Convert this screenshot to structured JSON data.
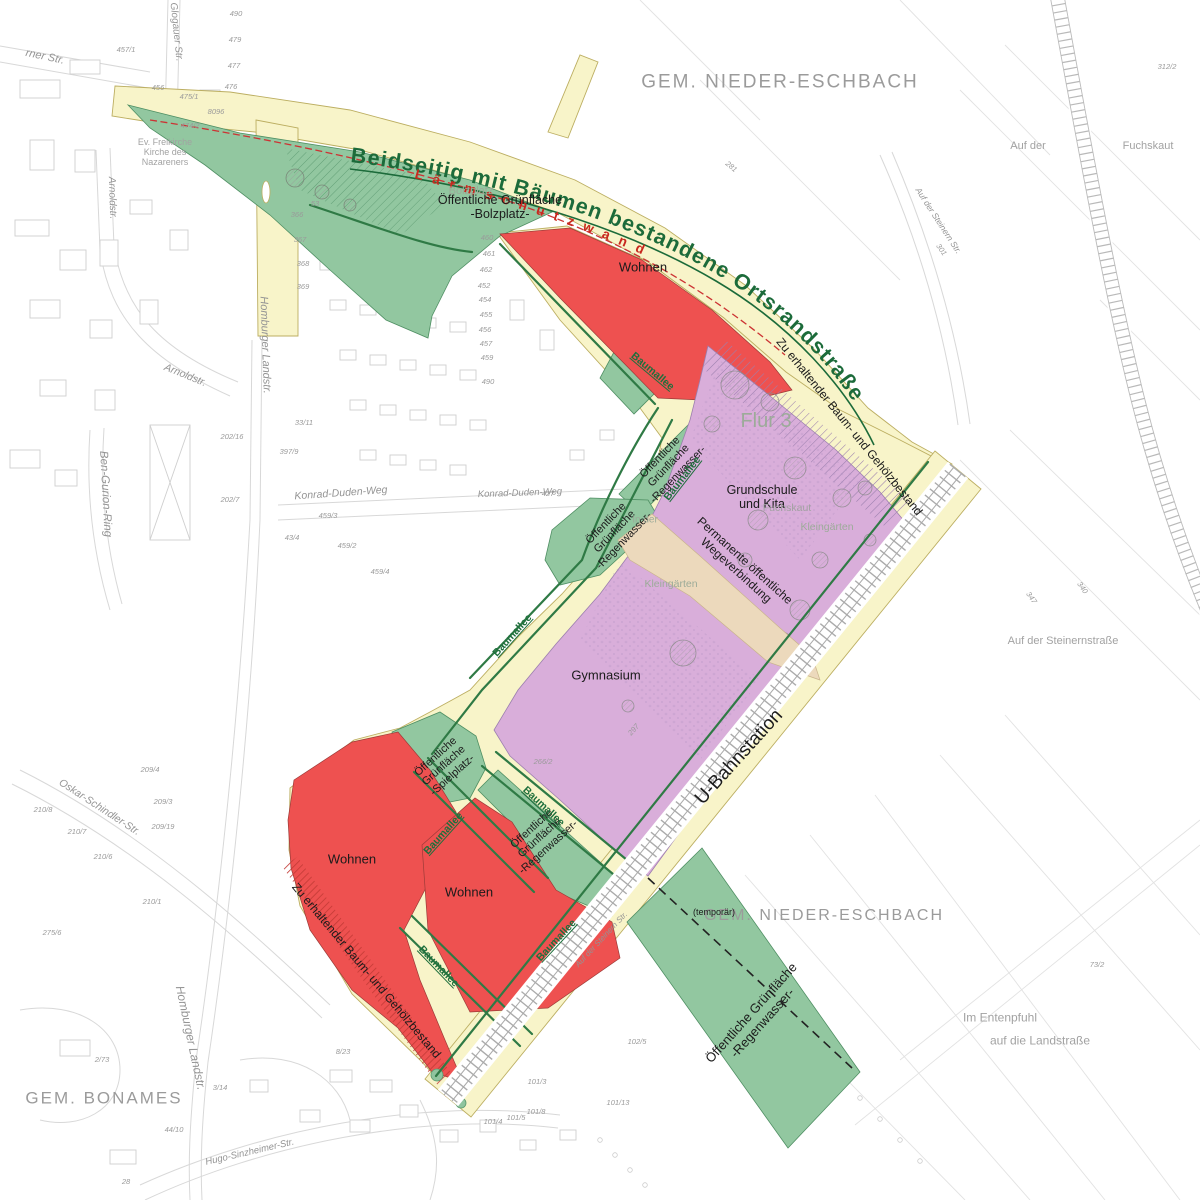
{
  "colors": {
    "road_yellow": "#f8f4c9",
    "road_edge": "#bcae61",
    "green_area": "#92c7a0",
    "green_edge": "#4f8f63",
    "red_area": "#ee5150",
    "red_hatch": "#c23a35",
    "purple_area": "#d9aeda",
    "purple_hatch": "#9b7fae",
    "tan_area": "#ecd9bc",
    "text_green": "#1c6b3a",
    "text_red": "#c8281e",
    "text_grey": "#9b9b9b",
    "rail_grey": "#909090"
  },
  "curved": {
    "ortsrandstrasse": "Beidseitig mit Bäumen bestandene Ortsrandstraße",
    "laermschutzwand": "Lärmschutzwand"
  },
  "map_labels": [
    {
      "n": "label-gem-nieder-eschbach-north",
      "t": "GEM. NIEDER-ESCHBACH",
      "x": 780,
      "y": 82,
      "s": 19,
      "c": "lab-region"
    },
    {
      "n": "label-gem-nieder-eschbach-south",
      "t": "GEM. NIEDER-ESCHBACH",
      "x": 824,
      "y": 916,
      "s": 16,
      "c": "lab-region"
    },
    {
      "n": "label-gem-bonames",
      "t": "GEM. BONAMES",
      "x": 104,
      "y": 1098,
      "s": 17,
      "c": "lab-region"
    },
    {
      "n": "label-wohnen-north",
      "t": "Wohnen",
      "x": 643,
      "y": 268,
      "s": 13,
      "c": "lab-zone"
    },
    {
      "n": "label-wohnen-west",
      "t": "Wohnen",
      "x": 352,
      "y": 860,
      "s": 13,
      "c": "lab-zone"
    },
    {
      "n": "label-wohnen-south",
      "t": "Wohnen",
      "x": 469,
      "y": 893,
      "s": 13,
      "c": "lab-zone"
    },
    {
      "n": "label-gymnasium",
      "t": "Gymnasium",
      "x": 606,
      "y": 676,
      "s": 13,
      "c": "lab-zone"
    },
    {
      "n": "label-grundschule-kita",
      "lines": [
        "Grundschule",
        "und Kita"
      ],
      "x": 762,
      "y": 497,
      "s": 12.5,
      "c": "lab-zone"
    },
    {
      "n": "label-gruenflaeche-bolzplatz",
      "lines": [
        "Öffentliche Grünfläche",
        "-Bolzplatz-"
      ],
      "x": 500,
      "y": 207,
      "s": 12.5,
      "c": "lab-zone"
    },
    {
      "n": "label-gruenflaeche-spielplatz",
      "lines": [
        "Öffentliche",
        "Grünfläche",
        "-Spielplatz-"
      ],
      "x": 444,
      "y": 766,
      "r": -42,
      "s": 11,
      "c": "lab-zone"
    },
    {
      "n": "label-gruenflaeche-regenwasser-west",
      "lines": [
        "Öffentliche",
        "Grünfläche",
        "-Regenwasser-"
      ],
      "x": 540,
      "y": 838,
      "r": -42,
      "s": 11,
      "c": "lab-zone"
    },
    {
      "n": "label-gruenflaeche-regenwasser-nord1",
      "lines": [
        "Öffentliche",
        "Grünfläche",
        "-Regenwasser-"
      ],
      "x": 669,
      "y": 466,
      "r": -46,
      "s": 11,
      "c": "lab-zone"
    },
    {
      "n": "label-gruenflaeche-regenwasser-nord2",
      "lines": [
        "Öffentliche",
        "Grünfläche",
        "-Regenwasser-"
      ],
      "x": 615,
      "y": 532,
      "r": -46,
      "s": 11,
      "c": "lab-zone"
    },
    {
      "n": "label-gruenflaeche-regenwasser-sued",
      "lines": [
        "Öffentliche Grünfläche",
        "-Regenwasser-"
      ],
      "x": 757,
      "y": 1018,
      "r": -48,
      "s": 13,
      "c": "lab-zone"
    },
    {
      "n": "label-temporaer",
      "t": "(temporär)",
      "x": 714,
      "y": 912,
      "s": 9,
      "c": "lab-zone"
    },
    {
      "n": "label-permanente-wegeverbindung",
      "lines": [
        "Permanente öffentliche",
        "Wegeverbindung"
      ],
      "x": 740,
      "y": 566,
      "r": 42,
      "s": 12,
      "c": "lab-zone"
    },
    {
      "n": "label-zu-erhaltender-bestand-north",
      "t": "Zu erhaltender Baum- und Gehölzbestand",
      "x": 849,
      "y": 427,
      "r": 51,
      "s": 12,
      "c": "lab-zone"
    },
    {
      "n": "label-zu-erhaltender-bestand-south",
      "t": "Zu erhaltender Baum- und Gehölzbestand",
      "x": 366,
      "y": 971,
      "r": 50,
      "s": 12,
      "c": "lab-zone"
    },
    {
      "n": "label-u-bahnstation",
      "t": "U-Bahnstation",
      "x": 739,
      "y": 757,
      "r": -48,
      "s": 19,
      "c": "lab-zone"
    },
    {
      "n": "label-flur-3",
      "t": "Flur 3",
      "x": 766,
      "y": 421,
      "s": 20,
      "c": "lab-greygreen"
    },
    {
      "n": "label-bolzplatz",
      "t": "Bolzplatz",
      "x": 471,
      "y": 191,
      "s": 11,
      "c": "lab-greygreen"
    },
    {
      "n": "label-kleingaerten-1",
      "t": "Kleingärten",
      "x": 827,
      "y": 528,
      "s": 10.5,
      "c": "lab-greygreen"
    },
    {
      "n": "label-kleingaerten-2",
      "t": "Kleingärten",
      "x": 671,
      "y": 585,
      "s": 10.5,
      "c": "lab-greygreen"
    },
    {
      "n": "label-fuchskaut-mitte",
      "t": "Fuchskaut",
      "x": 787,
      "y": 509,
      "s": 10.5,
      "c": "lab-grey"
    },
    {
      "n": "label-fuchskaut-nordost",
      "t": "Fuchskaut",
      "x": 1148,
      "y": 146,
      "s": 11,
      "c": "lab-grey"
    },
    {
      "n": "label-auf-der-nordost",
      "t": "Auf der",
      "x": 1028,
      "y": 146,
      "s": 11,
      "c": "lab-grey"
    },
    {
      "n": "label-auf-der-steinernstrasse",
      "t": "Auf der Steinernstraße",
      "x": 1063,
      "y": 641,
      "s": 11,
      "c": "lab-grey"
    },
    {
      "n": "label-im-entenpfuhl",
      "t": "Im Entenpfuhl",
      "x": 1000,
      "y": 1018,
      "s": 12,
      "c": "lab-grey"
    },
    {
      "n": "label-auf-die-landstrasse",
      "t": "auf die Landstraße",
      "x": 1040,
      "y": 1041,
      "s": 12,
      "c": "lab-grey"
    },
    {
      "n": "label-in-der",
      "t": "In der",
      "x": 645,
      "y": 520,
      "s": 10,
      "c": "lab-greygreen"
    },
    {
      "n": "label-ev-freikirche",
      "lines": [
        "Ev. Freikirche",
        "Kirche des",
        "Nazareners"
      ],
      "x": 165,
      "y": 152,
      "s": 9,
      "c": "lab-grey"
    },
    {
      "n": "label-baumallee-1",
      "t": "Baumallee",
      "x": 652,
      "y": 372,
      "r": 40,
      "s": 10.5,
      "c": "lab-green"
    },
    {
      "n": "label-baumallee-2",
      "t": "Baumallee",
      "x": 683,
      "y": 479,
      "r": -52,
      "s": 10.5,
      "c": "lab-green"
    },
    {
      "n": "label-baumallee-3",
      "t": "Baumallee",
      "x": 513,
      "y": 636,
      "r": -48,
      "s": 10.5,
      "c": "lab-green"
    },
    {
      "n": "label-baumallee-4",
      "t": "Baumallee",
      "x": 543,
      "y": 807,
      "r": 43,
      "s": 10.5,
      "c": "lab-green"
    },
    {
      "n": "label-baumallee-5",
      "t": "Baumallee",
      "x": 444,
      "y": 834,
      "r": -48,
      "s": 10.5,
      "c": "lab-green"
    },
    {
      "n": "label-baumallee-6",
      "t": "Baumallee",
      "x": 557,
      "y": 941,
      "r": -47,
      "s": 10.5,
      "c": "lab-green"
    },
    {
      "n": "label-baumallee-7",
      "t": "Baumallee",
      "x": 438,
      "y": 967,
      "r": 46,
      "s": 10.5,
      "c": "lab-green"
    },
    {
      "n": "label-glogauer-str",
      "t": "Glogauer Str.",
      "x": 176,
      "y": 32,
      "r": 84,
      "s": 10,
      "c": "lab-street"
    },
    {
      "n": "label-rner-str",
      "t": "rner Str.",
      "x": 45,
      "y": 57,
      "r": 12,
      "s": 11,
      "c": "lab-street"
    },
    {
      "n": "label-arnoldstr-1",
      "t": "Arnoldstr.",
      "x": 112,
      "y": 198,
      "r": 88,
      "s": 10,
      "c": "lab-street"
    },
    {
      "n": "label-arnoldstr-2",
      "t": "Arnoldstr.",
      "x": 185,
      "y": 376,
      "r": 22,
      "s": 10.5,
      "c": "lab-street"
    },
    {
      "n": "label-homburger-landstr-nord",
      "t": "Homburger Landstr.",
      "x": 265,
      "y": 345,
      "r": 88,
      "s": 11,
      "c": "lab-street"
    },
    {
      "n": "label-homburger-landstr-sued",
      "t": "Homburger Landstr.",
      "x": 190,
      "y": 1038,
      "r": 78,
      "s": 12,
      "c": "lab-street"
    },
    {
      "n": "label-ben-gurion-ring",
      "t": "Ben-Gurion-Ring",
      "x": 105,
      "y": 494,
      "r": 87,
      "s": 11.5,
      "c": "lab-street"
    },
    {
      "n": "label-konrad-duden-weg-1",
      "t": "Konrad-Duden-Weg",
      "x": 341,
      "y": 494,
      "r": -4,
      "s": 10.5,
      "c": "lab-street"
    },
    {
      "n": "label-konrad-duden-weg-2",
      "t": "Konrad-Duden-Weg",
      "x": 520,
      "y": 494,
      "r": -2,
      "s": 9.5,
      "c": "lab-street"
    },
    {
      "n": "label-oskar-schindler-str",
      "t": "Oskar-Schindler-Str.",
      "x": 99,
      "y": 808,
      "r": 33,
      "s": 10.5,
      "c": "lab-street"
    },
    {
      "n": "label-hugo-sinzheimer-str",
      "t": "Hugo-Sinzheimer-Str.",
      "x": 250,
      "y": 1153,
      "r": -13,
      "s": 9.5,
      "c": "lab-street"
    },
    {
      "n": "label-auf-der-steinern-str-rail1",
      "t": "Auf der Steinern Str.",
      "x": 938,
      "y": 221,
      "r": 57,
      "s": 8.5,
      "c": "lab-street"
    },
    {
      "n": "label-auf-der-steinern-str-rail2",
      "t": "Auf der Steinern Str.",
      "x": 602,
      "y": 940,
      "r": -47,
      "s": 8,
      "c": "lab-street"
    },
    {
      "n": "parcel-number",
      "t": "490",
      "x": 236,
      "y": 14,
      "s": 7.5,
      "c": "lab-parcel"
    },
    {
      "n": "parcel-number",
      "t": "479",
      "x": 235,
      "y": 40,
      "s": 7.5,
      "c": "lab-parcel"
    },
    {
      "n": "parcel-number",
      "t": "477",
      "x": 234,
      "y": 66,
      "s": 7.5,
      "c": "lab-parcel"
    },
    {
      "n": "parcel-number",
      "t": "476",
      "x": 231,
      "y": 87,
      "s": 7.5,
      "c": "lab-parcel"
    },
    {
      "n": "parcel-number",
      "t": "475/1",
      "x": 189,
      "y": 97,
      "s": 7.5,
      "c": "lab-parcel"
    },
    {
      "n": "parcel-number",
      "t": "474/2",
      "x": 190,
      "y": 126,
      "s": 7.5,
      "c": "lab-parcel"
    },
    {
      "n": "parcel-number",
      "t": "457/1",
      "x": 126,
      "y": 50,
      "s": 7.5,
      "c": "lab-parcel"
    },
    {
      "n": "parcel-number",
      "t": "456",
      "x": 158,
      "y": 88,
      "s": 7.5,
      "c": "lab-parcel"
    },
    {
      "n": "parcel-number",
      "t": "8096",
      "x": 216,
      "y": 112,
      "s": 7.5,
      "c": "lab-parcel"
    },
    {
      "n": "parcel-number",
      "t": "460",
      "x": 487,
      "y": 238,
      "s": 7.5,
      "c": "lab-parcel"
    },
    {
      "n": "parcel-number",
      "t": "461",
      "x": 489,
      "y": 254,
      "s": 7.5,
      "c": "lab-parcel"
    },
    {
      "n": "parcel-number",
      "t": "462",
      "x": 486,
      "y": 270,
      "s": 7.5,
      "c": "lab-parcel"
    },
    {
      "n": "parcel-number",
      "t": "452",
      "x": 484,
      "y": 286,
      "s": 7.5,
      "c": "lab-parcel"
    },
    {
      "n": "parcel-number",
      "t": "454",
      "x": 485,
      "y": 300,
      "s": 7.5,
      "c": "lab-parcel"
    },
    {
      "n": "parcel-number",
      "t": "455",
      "x": 486,
      "y": 315,
      "s": 7.5,
      "c": "lab-parcel"
    },
    {
      "n": "parcel-number",
      "t": "456",
      "x": 485,
      "y": 330,
      "s": 7.5,
      "c": "lab-parcel"
    },
    {
      "n": "parcel-number",
      "t": "457",
      "x": 486,
      "y": 344,
      "s": 7.5,
      "c": "lab-parcel"
    },
    {
      "n": "parcel-number",
      "t": "459",
      "x": 487,
      "y": 358,
      "s": 7.5,
      "c": "lab-parcel"
    },
    {
      "n": "parcel-number",
      "t": "490",
      "x": 488,
      "y": 382,
      "s": 7.5,
      "c": "lab-parcel"
    },
    {
      "n": "parcel-number",
      "t": "427",
      "x": 548,
      "y": 494,
      "s": 7.5,
      "c": "lab-parcel"
    },
    {
      "n": "parcel-number",
      "t": "43/4",
      "x": 292,
      "y": 538,
      "s": 7.5,
      "c": "lab-parcel"
    },
    {
      "n": "parcel-number",
      "t": "459/2",
      "x": 347,
      "y": 546,
      "s": 7.5,
      "c": "lab-parcel"
    },
    {
      "n": "parcel-number",
      "t": "459/3",
      "x": 328,
      "y": 516,
      "s": 7.5,
      "c": "lab-parcel"
    },
    {
      "n": "parcel-number",
      "t": "459/4",
      "x": 380,
      "y": 572,
      "s": 7.5,
      "c": "lab-parcel"
    },
    {
      "n": "parcel-number",
      "t": "202/7",
      "x": 230,
      "y": 500,
      "s": 7.5,
      "c": "lab-parcel"
    },
    {
      "n": "parcel-number",
      "t": "202/16",
      "x": 232,
      "y": 437,
      "s": 7.5,
      "c": "lab-parcel"
    },
    {
      "n": "parcel-number",
      "t": "397/9",
      "x": 289,
      "y": 452,
      "s": 7.5,
      "c": "lab-parcel"
    },
    {
      "n": "parcel-number",
      "t": "33/11",
      "x": 304,
      "y": 423,
      "s": 7.5,
      "c": "lab-parcel"
    },
    {
      "n": "parcel-number",
      "t": "312/2",
      "x": 1167,
      "y": 67,
      "s": 7.5,
      "c": "lab-parcel"
    },
    {
      "n": "parcel-number",
      "t": "281",
      "x": 731,
      "y": 167,
      "r": 40,
      "s": 7.5,
      "c": "lab-parcel"
    },
    {
      "n": "parcel-number",
      "t": "301",
      "x": 941,
      "y": 250,
      "r": 55,
      "s": 7.5,
      "c": "lab-parcel"
    },
    {
      "n": "parcel-number",
      "t": "340",
      "x": 1082,
      "y": 588,
      "r": 55,
      "s": 7.5,
      "c": "lab-parcel"
    },
    {
      "n": "parcel-number",
      "t": "347",
      "x": 1031,
      "y": 598,
      "r": 55,
      "s": 7.5,
      "c": "lab-parcel"
    },
    {
      "n": "parcel-number",
      "t": "73/2",
      "x": 1097,
      "y": 965,
      "s": 7.5,
      "c": "lab-parcel"
    },
    {
      "n": "parcel-number",
      "t": "101/13",
      "x": 618,
      "y": 1103,
      "s": 7.5,
      "c": "lab-parcel"
    },
    {
      "n": "parcel-number",
      "t": "101/3",
      "x": 537,
      "y": 1082,
      "s": 7.5,
      "c": "lab-parcel"
    },
    {
      "n": "parcel-number",
      "t": "101/8",
      "x": 536,
      "y": 1112,
      "s": 7.5,
      "c": "lab-parcel"
    },
    {
      "n": "parcel-number",
      "t": "101/5",
      "x": 516,
      "y": 1118,
      "s": 7.5,
      "c": "lab-parcel"
    },
    {
      "n": "parcel-number",
      "t": "101/4",
      "x": 493,
      "y": 1122,
      "s": 7.5,
      "c": "lab-parcel"
    },
    {
      "n": "parcel-number",
      "t": "102/5",
      "x": 637,
      "y": 1042,
      "s": 7.5,
      "c": "lab-parcel"
    },
    {
      "n": "parcel-number",
      "t": "210/1",
      "x": 152,
      "y": 902,
      "s": 7.5,
      "c": "lab-parcel"
    },
    {
      "n": "parcel-number",
      "t": "210/6",
      "x": 103,
      "y": 857,
      "s": 7.5,
      "c": "lab-parcel"
    },
    {
      "n": "parcel-number",
      "t": "210/7",
      "x": 77,
      "y": 832,
      "s": 7.5,
      "c": "lab-parcel"
    },
    {
      "n": "parcel-number",
      "t": "210/8",
      "x": 43,
      "y": 810,
      "s": 7.5,
      "c": "lab-parcel"
    },
    {
      "n": "parcel-number",
      "t": "209/3",
      "x": 163,
      "y": 802,
      "s": 7.5,
      "c": "lab-parcel"
    },
    {
      "n": "parcel-number",
      "t": "209/4",
      "x": 150,
      "y": 770,
      "s": 7.5,
      "c": "lab-parcel"
    },
    {
      "n": "parcel-number",
      "t": "209/19",
      "x": 163,
      "y": 827,
      "s": 7.5,
      "c": "lab-parcel"
    },
    {
      "n": "parcel-number",
      "t": "275/6",
      "x": 52,
      "y": 933,
      "s": 7.5,
      "c": "lab-parcel"
    },
    {
      "n": "parcel-number",
      "t": "8/23",
      "x": 343,
      "y": 1052,
      "s": 7.5,
      "c": "lab-parcel"
    },
    {
      "n": "parcel-number",
      "t": "2/73",
      "x": 102,
      "y": 1060,
      "s": 7.5,
      "c": "lab-parcel"
    },
    {
      "n": "parcel-number",
      "t": "3/14",
      "x": 220,
      "y": 1088,
      "s": 7.5,
      "c": "lab-parcel"
    },
    {
      "n": "parcel-number",
      "t": "44/10",
      "x": 174,
      "y": 1130,
      "s": 7.5,
      "c": "lab-parcel"
    },
    {
      "n": "parcel-number",
      "t": "28",
      "x": 126,
      "y": 1182,
      "s": 7.5,
      "c": "lab-parcel"
    },
    {
      "n": "parcel-number",
      "t": "53",
      "x": 315,
      "y": 204,
      "s": 7.5,
      "c": "lab-parcel"
    },
    {
      "n": "parcel-number",
      "t": "366",
      "x": 297,
      "y": 215,
      "s": 7.5,
      "c": "lab-parcel"
    },
    {
      "n": "parcel-number",
      "t": "367",
      "x": 300,
      "y": 240,
      "s": 7.5,
      "c": "lab-parcel"
    },
    {
      "n": "parcel-number",
      "t": "368",
      "x": 303,
      "y": 264,
      "s": 7.5,
      "c": "lab-parcel"
    },
    {
      "n": "parcel-number",
      "t": "369",
      "x": 303,
      "y": 287,
      "s": 7.5,
      "c": "lab-parcel"
    },
    {
      "n": "parcel-number",
      "t": "297",
      "x": 634,
      "y": 730,
      "r": -48,
      "s": 7.5,
      "c": "lab-parcel"
    },
    {
      "n": "parcel-number",
      "t": "266/2",
      "x": 543,
      "y": 762,
      "s": 7.5,
      "c": "lab-parcel"
    }
  ]
}
